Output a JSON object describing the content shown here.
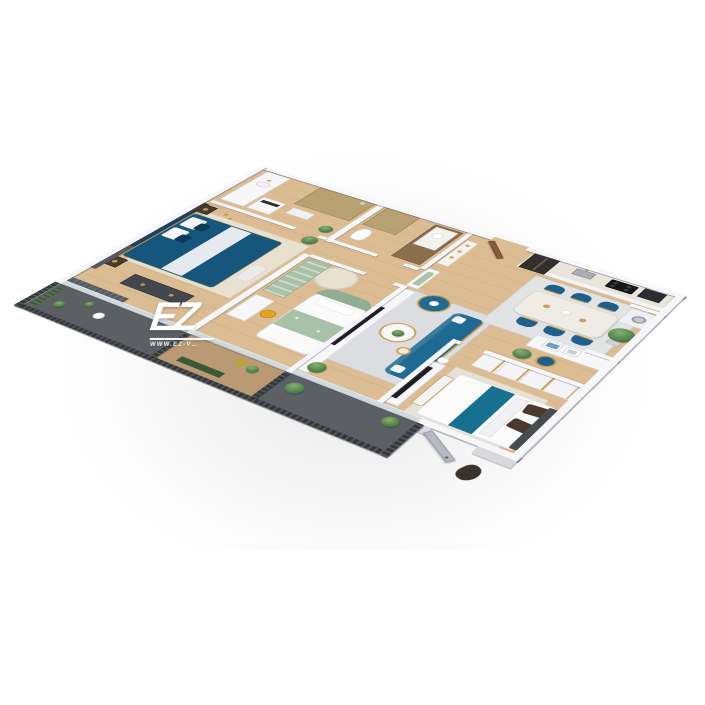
{
  "title": "3D isometric apartment floor plan render",
  "watermark": {
    "logo": "EZ",
    "url": "WWW.EZ-V…"
  },
  "colors": {
    "wood": "#dcbd93",
    "woodLine": "rgba(140,100,55,0.16)",
    "wall": "#f7f7f9",
    "navy": "#17567c",
    "headboard": "#1d3f63",
    "sofa": "#1f6a93",
    "tealRunner": "#15718f",
    "chairNavy": "#1e5f8e",
    "sage": "#a9c0a9",
    "sageDeep": "#8fae92",
    "gold": "#c9a04e",
    "marble": "#efece5",
    "rugGrey": "#dcdde0",
    "rugCream": "#e9e1d0",
    "railDark": "#34383d",
    "balconyFloor": "#5c6065",
    "curtain": "#555a61",
    "glassOlive": "rgba(148,136,86,0.5)",
    "glassEdge": "#8d8152",
    "doorWood": "#8a5a3a",
    "doorGrey": "#b7bac1",
    "yellow": "#e3a422",
    "plant": "#51804b",
    "plantDeep": "#3c5836",
    "dark": "#33302e",
    "washer": "#eef0f3",
    "tv": "#1c1e22",
    "window": "#cfd9de"
  },
  "scene": {
    "type": "isometric-3d-floor-plan",
    "rooms": [
      "master-bedroom",
      "master-bathroom",
      "bathroom-2",
      "entry-hallway",
      "kids-bedroom",
      "living-room",
      "dining-area",
      "kitchen",
      "laundry-niche",
      "study-nook",
      "bedroom-2",
      "balcony-master",
      "balcony-kids",
      "balcony-living"
    ]
  }
}
